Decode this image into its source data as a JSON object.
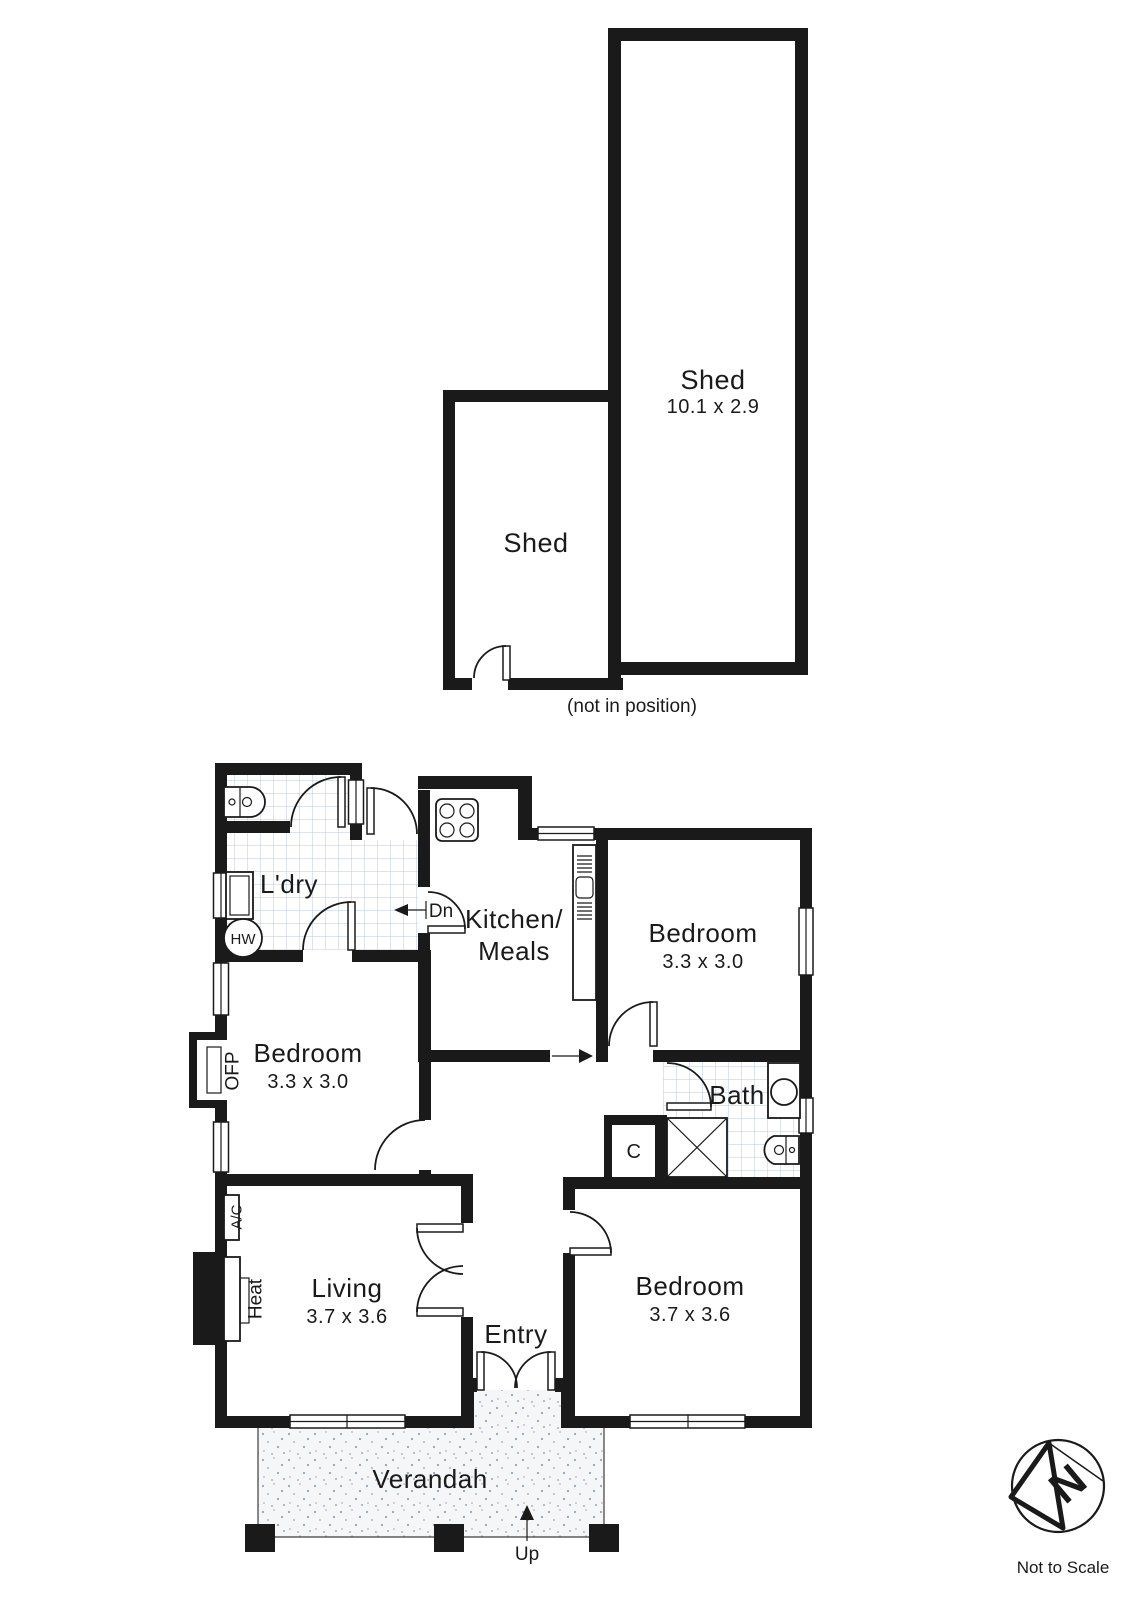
{
  "sheds": {
    "large": {
      "label": "Shed",
      "dims": "10.1 x 2.9"
    },
    "small": {
      "label": "Shed"
    },
    "note": "(not in position)"
  },
  "rooms": {
    "laundry": {
      "label": "L'dry"
    },
    "kitchen": {
      "line1": "Kitchen/",
      "line2": "Meals"
    },
    "bedroom_rear": {
      "label": "Bedroom",
      "dims": "3.3 x 3.0"
    },
    "bedroom_middle": {
      "label": "Bedroom",
      "dims": "3.3 x 3.0"
    },
    "bedroom_front": {
      "label": "Bedroom",
      "dims": "3.7 x 3.6"
    },
    "living": {
      "label": "Living",
      "dims": "3.7 x 3.6"
    },
    "bath": {
      "label": "Bath"
    },
    "closet": {
      "label": "C"
    },
    "entry": {
      "label": "Entry"
    },
    "verandah": {
      "label": "Verandah"
    }
  },
  "fixtures": {
    "hot_water": "HW",
    "fireplace": "OFP",
    "air_conditioner": "A/C",
    "heater": "Heat"
  },
  "stairs": {
    "down": "Dn",
    "up": "Up"
  },
  "compass": {
    "north": "N",
    "scale_note": "Not to Scale"
  },
  "colors": {
    "wall": "#1a1a1a",
    "tile_line": "#bccadd",
    "background": "#ffffff"
  }
}
